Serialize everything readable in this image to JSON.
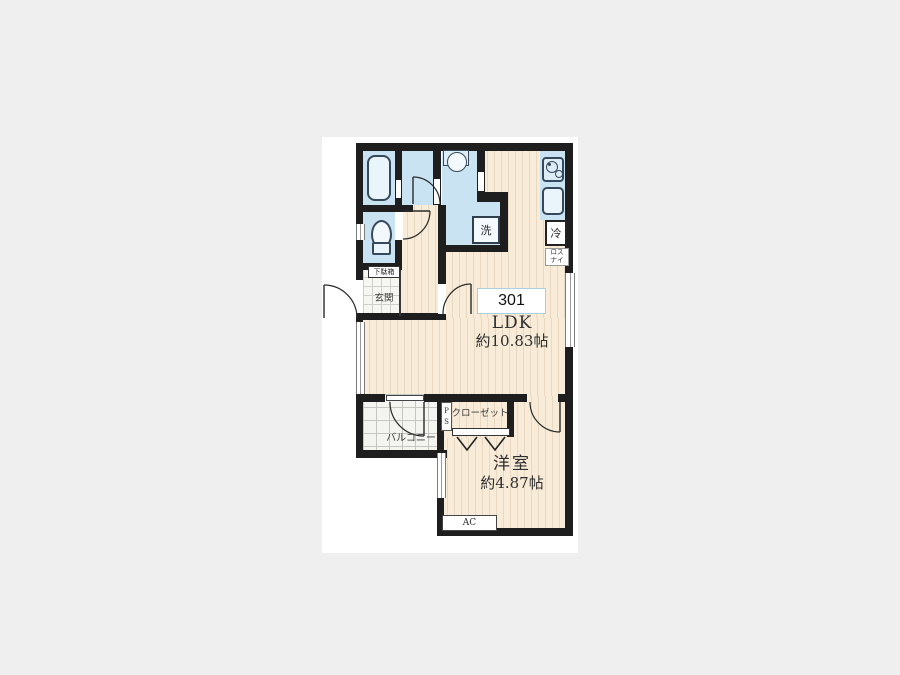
{
  "unit": {
    "number": "301"
  },
  "rooms": {
    "ldk": {
      "name": "LDK",
      "area": "約10.83帖"
    },
    "western_room": {
      "name": "洋室",
      "area": "約4.87帖"
    },
    "balcony": {
      "label": "バルコニー"
    },
    "closet": {
      "label": "クローゼット"
    },
    "entrance": {
      "label": "玄関"
    },
    "shoe_cabinet": {
      "label": "下駄箱"
    },
    "pipe_space": {
      "label": "PS",
      "line1": "P",
      "line2": "S"
    }
  },
  "equipment": {
    "washer": {
      "label": "洗"
    },
    "fridge": {
      "label": "冷"
    },
    "lossnay": {
      "label": "ロスナイ",
      "line1": "ロス",
      "line2": "ナイ"
    },
    "ac": {
      "label": "AC"
    }
  },
  "palette": {
    "wall": "#1e1e1e",
    "wet_area": "#c9e3f2",
    "floor": "#f8ecd9",
    "floor_stripe": "#ead9c2",
    "badge_border": "#abcfe0",
    "page_background": "#efeff0"
  }
}
